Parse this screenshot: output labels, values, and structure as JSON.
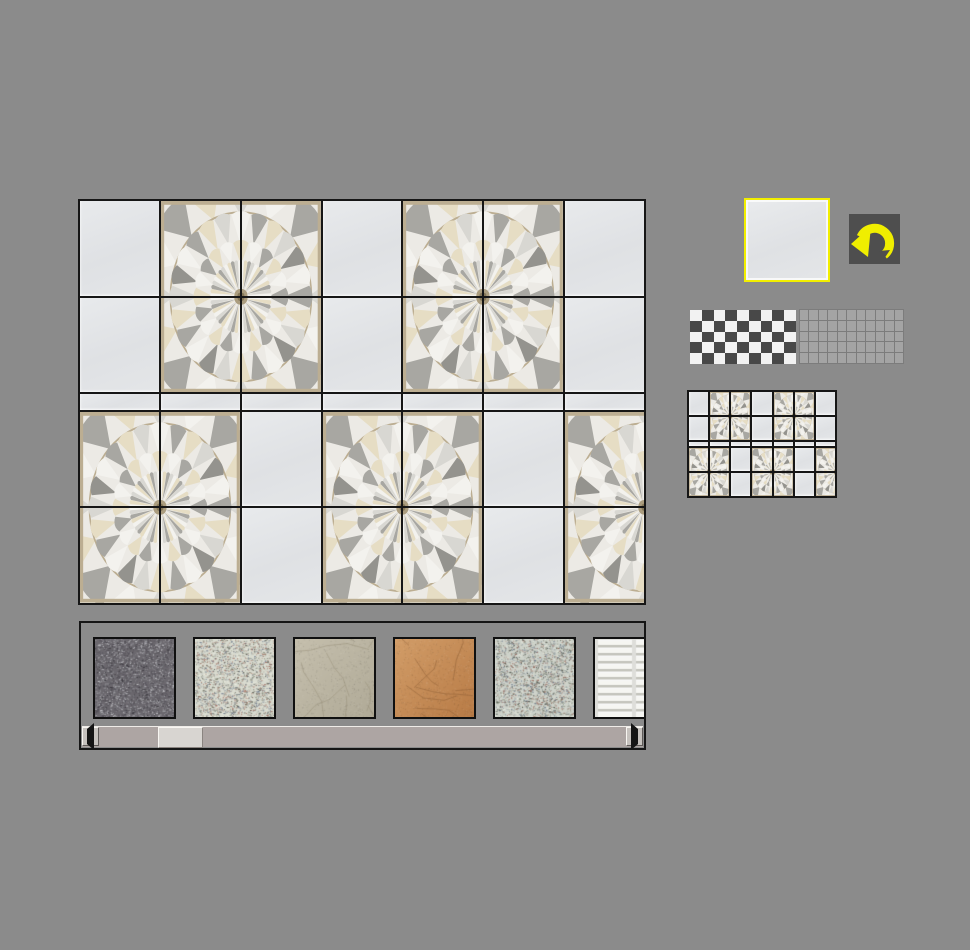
{
  "app": {
    "name": "tile-layout-designer",
    "background_color": "#8b8b8b",
    "visible_text": "none"
  },
  "tile_designer": {
    "grid": {
      "columns": 7,
      "rows": 5,
      "code_legend": {
        "P": "plain light-gray tile",
        "TL": "mandala pattern quad, top-left tile",
        "TR": "mandala pattern quad, top-right tile",
        "BL": "mandala pattern quad, bottom-left tile",
        "BR": "mandala pattern quad, bottom-right tile"
      },
      "tile_map": [
        [
          "P",
          "TL",
          "TR",
          "P",
          "TL",
          "TR",
          "P"
        ],
        [
          "P",
          "BL",
          "BR",
          "P",
          "BL",
          "BR",
          "P"
        ],
        [
          "P",
          "P",
          "P",
          "P",
          "P",
          "P",
          "P"
        ],
        [
          "TL",
          "TR",
          "P",
          "TL",
          "TR",
          "P",
          "TL"
        ],
        [
          "BL",
          "BR",
          "P",
          "BL",
          "BR",
          "P",
          "BL"
        ]
      ],
      "grid_line_color": "#161616",
      "plain_tile_color": "#e2e4e6",
      "mandala_colors": {
        "background": "#eceae5",
        "white": "#f3f2ee",
        "light_gray": "#d8d7d2",
        "mid_gray": "#a8a7a2",
        "dark_gray": "#94938e",
        "beige": "#e6ddc4",
        "tan_frame": "#bcae92",
        "center": "#ab9d7f"
      }
    }
  },
  "selection_panel": {
    "selected_tile": {
      "type": "plain",
      "highlight_border_color": "#f2ee00",
      "fill_color": "#e2e4e6"
    },
    "rotate_button": {
      "icon": "rotate-counterclockwise-arrow-icon",
      "arrow_color": "#f0ee00",
      "background_color": "#4e4e4e"
    }
  },
  "pattern_swatches": {
    "checkerboard": {
      "columns": 9,
      "rows": 5,
      "color_a": "#f2f2f2",
      "color_b": "#484848",
      "first_cell": "light"
    },
    "uniform_grid": {
      "columns": 11,
      "rows": 5,
      "cell_color": "#a4a4a4",
      "line_color": "#7c7c7c"
    }
  },
  "preview_minimap": {
    "columns": 7,
    "rows": 5,
    "layout": "same pattern as tile_designer.grid.tile_map"
  },
  "texture_palette": {
    "swatches": [
      {
        "name": "dark-granite-speckle",
        "type": "speckle",
        "base": "#6b686e",
        "speckle_colors": [
          "#3c3a40",
          "#9fa0a4",
          "#55525a",
          "#c9c9cd"
        ]
      },
      {
        "name": "light-terrazzo-speckle",
        "type": "speckle",
        "base": "#d9dbd0",
        "speckle_colors": [
          "#8e9180",
          "#a06a5c",
          "#6a7588",
          "#5a5a50",
          "#eceee2"
        ]
      },
      {
        "name": "beige-crackle-ceramic",
        "type": "crackle",
        "base": "#c5bfad",
        "base2": "#b0aa97",
        "crack": "#948d77"
      },
      {
        "name": "terracotta-crackle",
        "type": "crackle",
        "base": "#d29d68",
        "base2": "#b87b46",
        "crack": "#8a5c34"
      },
      {
        "name": "light-terrazzo-speckle-2",
        "type": "speckle",
        "base": "#ced2ca",
        "speckle_colors": [
          "#89907e",
          "#9a6a5e",
          "#68788c",
          "#50544c",
          "#e8ece0"
        ]
      },
      {
        "name": "white-relief-bricks",
        "type": "bricks",
        "base": "#dededa",
        "brick": "#f6f6f2",
        "shadow": "#c2c2ba"
      }
    ],
    "scrollbar": {
      "orientation": "horizontal",
      "left_button_icon": "arrow-left-icon",
      "right_button_icon": "arrow-right-icon",
      "thumb_left_px": 76,
      "thumb_width_px": 43
    }
  }
}
